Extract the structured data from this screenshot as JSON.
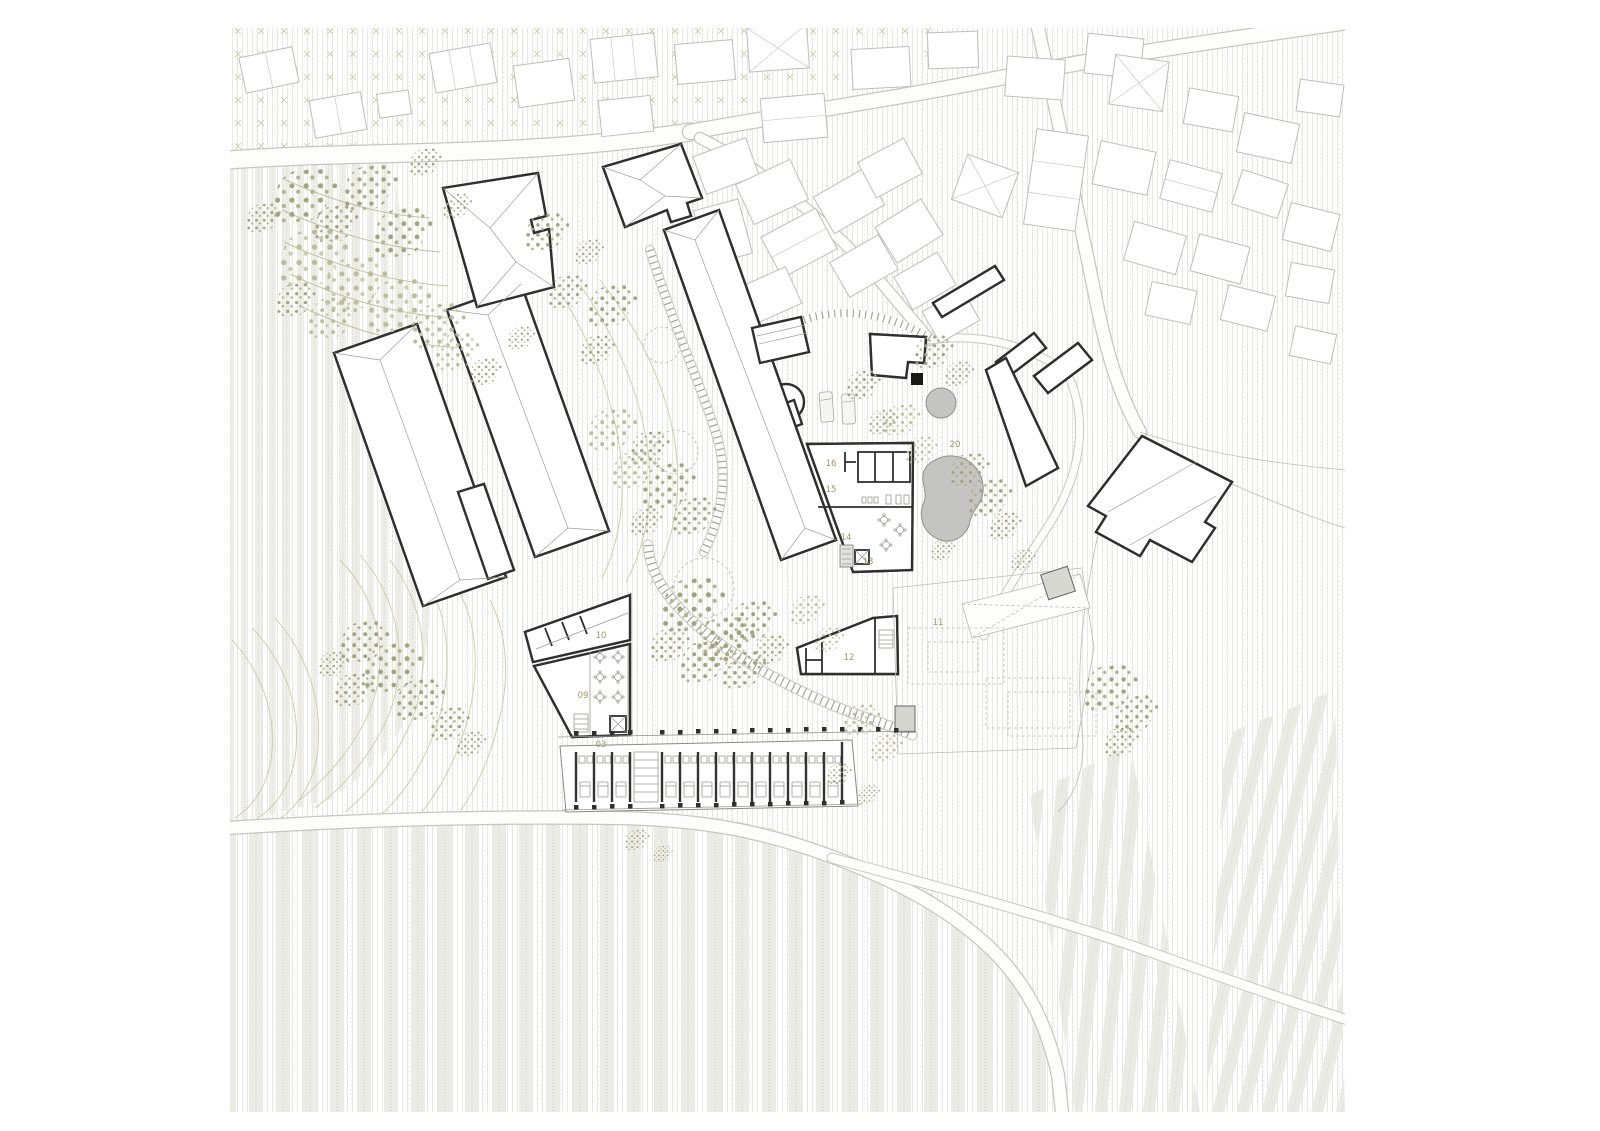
{
  "plan": {
    "kind": "architectural masterplan site drawing",
    "zone_labels": [
      "03",
      "09",
      "10",
      "11",
      "12",
      "13",
      "14",
      "15",
      "16",
      "20"
    ],
    "features": {
      "pool": "biomorphic swimming pool",
      "round_pool": "circular plunge pool",
      "vineyard": "vineyard row fields",
      "orchard": "orchard hatch field",
      "trees": "stippled tree canopies",
      "entrance_marker": "black entrance square"
    },
    "palette": {
      "wall": "#2f2f2f",
      "context_outline": "#bdbdbb",
      "foliage": "#a3a37e",
      "foliage_light": "#bdbd9b",
      "contour": "#d0c8a9",
      "pool_fill": "#c4c4c2",
      "label": "#a09468",
      "field_band": "#ecece6"
    }
  }
}
